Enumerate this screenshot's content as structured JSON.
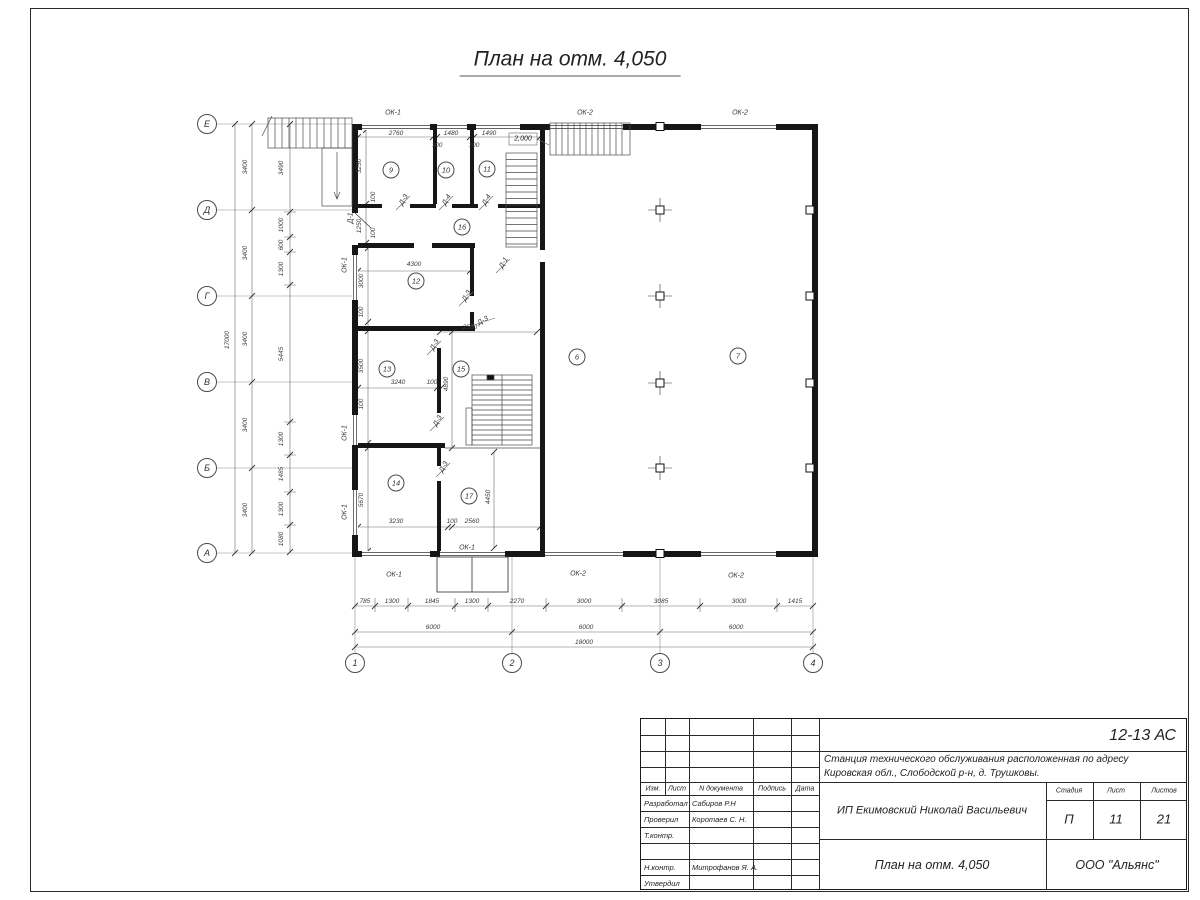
{
  "page_title": "План на отм. 4,050",
  "plan": {
    "axes_letters": [
      {
        "l": "Е",
        "x": 207,
        "y": 124
      },
      {
        "l": "Д",
        "x": 207,
        "y": 210
      },
      {
        "l": "Г",
        "x": 207,
        "y": 296
      },
      {
        "l": "В",
        "x": 207,
        "y": 382
      },
      {
        "l": "Б",
        "x": 207,
        "y": 468
      },
      {
        "l": "А",
        "x": 207,
        "y": 553
      }
    ],
    "axes_numbers": [
      {
        "l": "1",
        "x": 355,
        "y": 663
      },
      {
        "l": "2",
        "x": 512,
        "y": 663
      },
      {
        "l": "3",
        "x": 660,
        "y": 663
      },
      {
        "l": "4",
        "x": 813,
        "y": 663
      }
    ],
    "rooms": [
      {
        "n": "9",
        "x": 391,
        "y": 170
      },
      {
        "n": "10",
        "x": 446,
        "y": 170
      },
      {
        "n": "11",
        "x": 487,
        "y": 169
      },
      {
        "n": "16",
        "x": 462,
        "y": 227
      },
      {
        "n": "12",
        "x": 416,
        "y": 281
      },
      {
        "n": "13",
        "x": 387,
        "y": 369
      },
      {
        "n": "15",
        "x": 461,
        "y": 369
      },
      {
        "n": "14",
        "x": 396,
        "y": 483
      },
      {
        "n": "17",
        "x": 469,
        "y": 496
      },
      {
        "n": "6",
        "x": 577,
        "y": 357
      },
      {
        "n": "7",
        "x": 738,
        "y": 356
      }
    ],
    "texts": [
      {
        "t": "2760",
        "x": 396,
        "y": 134
      },
      {
        "t": "100",
        "x": 437,
        "y": 146
      },
      {
        "t": "1480",
        "x": 451,
        "y": 134
      },
      {
        "t": "100",
        "x": 474,
        "y": 146
      },
      {
        "t": "1490",
        "x": 489,
        "y": 134
      },
      {
        "t": "3250",
        "x": 360,
        "y": 166,
        "r": -90
      },
      {
        "t": "100",
        "x": 374,
        "y": 197,
        "r": -90
      },
      {
        "t": "1250",
        "x": 360,
        "y": 226,
        "r": -90
      },
      {
        "t": "100",
        "x": 374,
        "y": 233,
        "r": -90
      },
      {
        "t": "4300",
        "x": 414,
        "y": 265
      },
      {
        "t": "3000",
        "x": 362,
        "y": 281,
        "r": -90
      },
      {
        "t": "100",
        "x": 362,
        "y": 312,
        "r": -90
      },
      {
        "t": "2550",
        "x": 470,
        "y": 328
      },
      {
        "t": "3240",
        "x": 398,
        "y": 383
      },
      {
        "t": "100",
        "x": 432,
        "y": 383
      },
      {
        "t": "3500",
        "x": 362,
        "y": 366,
        "r": -90
      },
      {
        "t": "100",
        "x": 362,
        "y": 404,
        "r": -90
      },
      {
        "t": "4890",
        "x": 447,
        "y": 384,
        "r": -90
      },
      {
        "t": "5670",
        "x": 362,
        "y": 500,
        "r": -90
      },
      {
        "t": "3230",
        "x": 396,
        "y": 522
      },
      {
        "t": "100",
        "x": 452,
        "y": 522
      },
      {
        "t": "2560",
        "x": 472,
        "y": 522
      },
      {
        "t": "4450",
        "x": 489,
        "y": 497,
        "r": -90
      },
      {
        "t": "785",
        "x": 365,
        "y": 602
      },
      {
        "t": "1300",
        "x": 392,
        "y": 602
      },
      {
        "t": "1845",
        "x": 432,
        "y": 602
      },
      {
        "t": "1300",
        "x": 472,
        "y": 602
      },
      {
        "t": "2270",
        "x": 517,
        "y": 602
      },
      {
        "t": "3000",
        "x": 584,
        "y": 602
      },
      {
        "t": "3085",
        "x": 661,
        "y": 602
      },
      {
        "t": "3000",
        "x": 739,
        "y": 602
      },
      {
        "t": "1415",
        "x": 795,
        "y": 602
      },
      {
        "t": "6000",
        "x": 433,
        "y": 628
      },
      {
        "t": "6000",
        "x": 586,
        "y": 628
      },
      {
        "t": "6000",
        "x": 736,
        "y": 628
      },
      {
        "t": "18000",
        "x": 584,
        "y": 643
      },
      {
        "t": "3400",
        "x": 246,
        "y": 167,
        "r": -90
      },
      {
        "t": "3400",
        "x": 246,
        "y": 253,
        "r": -90
      },
      {
        "t": "3400",
        "x": 246,
        "y": 339,
        "r": -90
      },
      {
        "t": "3400",
        "x": 246,
        "y": 425,
        "r": -90
      },
      {
        "t": "3400",
        "x": 246,
        "y": 510,
        "r": -90
      },
      {
        "t": "17000",
        "x": 228,
        "y": 340,
        "r": -90
      },
      {
        "t": "3490",
        "x": 282,
        "y": 168,
        "r": -90
      },
      {
        "t": "1000",
        "x": 282,
        "y": 225,
        "r": -90
      },
      {
        "t": "600",
        "x": 282,
        "y": 245,
        "r": -90
      },
      {
        "t": "1300",
        "x": 282,
        "y": 269,
        "r": -90
      },
      {
        "t": "5445",
        "x": 282,
        "y": 354,
        "r": -90
      },
      {
        "t": "1300",
        "x": 282,
        "y": 439,
        "r": -90
      },
      {
        "t": "1485",
        "x": 282,
        "y": 474,
        "r": -90
      },
      {
        "t": "1300",
        "x": 282,
        "y": 509,
        "r": -90
      },
      {
        "t": "1080",
        "x": 282,
        "y": 539,
        "r": -90
      },
      {
        "t": "ОК-1",
        "x": 393,
        "y": 113,
        "k": "window-label"
      },
      {
        "t": "ОК-2",
        "x": 585,
        "y": 113,
        "k": "window-label"
      },
      {
        "t": "ОК-2",
        "x": 740,
        "y": 113,
        "k": "window-label"
      },
      {
        "t": "ОК-1",
        "x": 345,
        "y": 265,
        "r": -90,
        "k": "window-label"
      },
      {
        "t": "ОК-1",
        "x": 345,
        "y": 433,
        "r": -90,
        "k": "window-label"
      },
      {
        "t": "ОК-1",
        "x": 345,
        "y": 512,
        "r": -90,
        "k": "window-label"
      },
      {
        "t": "ОК-1",
        "x": 394,
        "y": 575,
        "k": "window-label"
      },
      {
        "t": "ОК-1",
        "x": 467,
        "y": 548,
        "k": "window-label"
      },
      {
        "t": "ОК-2",
        "x": 578,
        "y": 574,
        "k": "window-label"
      },
      {
        "t": "ОК-2",
        "x": 736,
        "y": 576,
        "k": "window-label"
      },
      {
        "t": "Д-3",
        "x": 404,
        "y": 200,
        "r": -60,
        "k": "door-label"
      },
      {
        "t": "Д-4",
        "x": 447,
        "y": 200,
        "r": -60,
        "k": "door-label"
      },
      {
        "t": "Д-4",
        "x": 487,
        "y": 200,
        "r": -60,
        "k": "door-label"
      },
      {
        "t": "Д-1",
        "x": 351,
        "y": 218,
        "r": -90,
        "k": "door-label"
      },
      {
        "t": "Д-1",
        "x": 504,
        "y": 263,
        "r": -60,
        "k": "door-label"
      },
      {
        "t": "Д-3",
        "x": 467,
        "y": 296,
        "r": -60,
        "k": "door-label"
      },
      {
        "t": "Д-3",
        "x": 483,
        "y": 321,
        "r": -30,
        "k": "door-label"
      },
      {
        "t": "Д-3",
        "x": 435,
        "y": 345,
        "r": -60,
        "k": "door-label"
      },
      {
        "t": "Д-3",
        "x": 438,
        "y": 421,
        "r": -60,
        "k": "door-label"
      },
      {
        "t": "Д-3",
        "x": 444,
        "y": 467,
        "r": -60,
        "k": "door-label"
      },
      {
        "t": "2,000",
        "x": 523,
        "y": 139,
        "k": "level-mark"
      }
    ]
  },
  "stamp": {
    "doc_code": "12-13 АС",
    "object_line1": "Станция технического обслуживания расположенная по адресу",
    "object_line2": "Кировская обл., Слободской р-н, д. Трушковы.",
    "client": "ИП Екимовский Николай Васильевич",
    "drawing_name": "План на отм. 4,050",
    "org": "ООО \"Альянс\"",
    "col_izm": "Изм.",
    "col_list": "Лист",
    "col_ndoc": "N документа",
    "col_podp": "Подпись",
    "col_data": "Дата",
    "stage_h": "Стадия",
    "sheet_h": "Лист",
    "sheets_h": "Листов",
    "stage": "П",
    "sheet": "11",
    "sheets": "21",
    "roles": [
      {
        "r": "Разработал",
        "n": "Сабиров Р.Н"
      },
      {
        "r": "Проверил",
        "n": "Коротаев С. Н."
      },
      {
        "r": "Т.контр.",
        "n": ""
      },
      {
        "r": "",
        "n": ""
      },
      {
        "r": "Н.контр.",
        "n": "Митрофанов Я. А."
      },
      {
        "r": "Утвердил",
        "n": ""
      }
    ]
  }
}
